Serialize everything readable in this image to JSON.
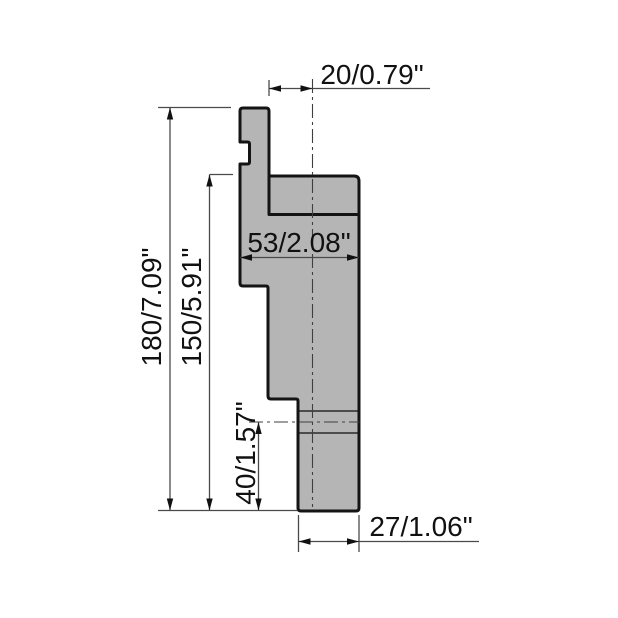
{
  "page": {
    "background": "#ffffff"
  },
  "drawing": {
    "type": "technical-drawing-side-profile",
    "colors": {
      "part_fill": "#b5b5b5",
      "outline": "#141414",
      "dimension_lines": "#4a4a4a",
      "centerline": "#3f3f3f",
      "text": "#111111"
    },
    "dimensions": {
      "top_width_label": "20/0.79\"",
      "flange_width_label": "53/2.08\"",
      "total_height_label": "180/7.09\"",
      "upper_height_label": "150/5.91\"",
      "lower_height_label": "40/1.57\"",
      "bottom_width_label": "27/1.06\""
    }
  }
}
